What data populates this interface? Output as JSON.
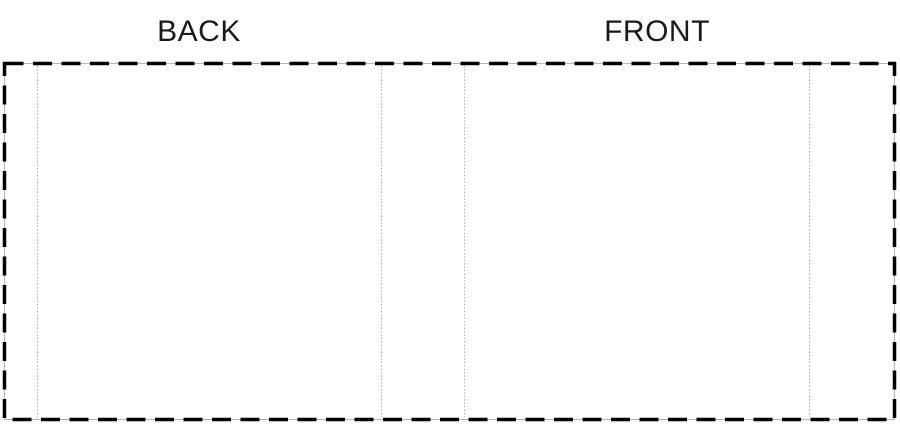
{
  "labels": {
    "back": "BACK",
    "front": "FRONT"
  },
  "colors": {
    "background": "#ffffff",
    "text": "#1a1a1a",
    "cut_line": "#000000",
    "trim_line": "#b5b5b5",
    "fold_line": "#999999"
  }
}
